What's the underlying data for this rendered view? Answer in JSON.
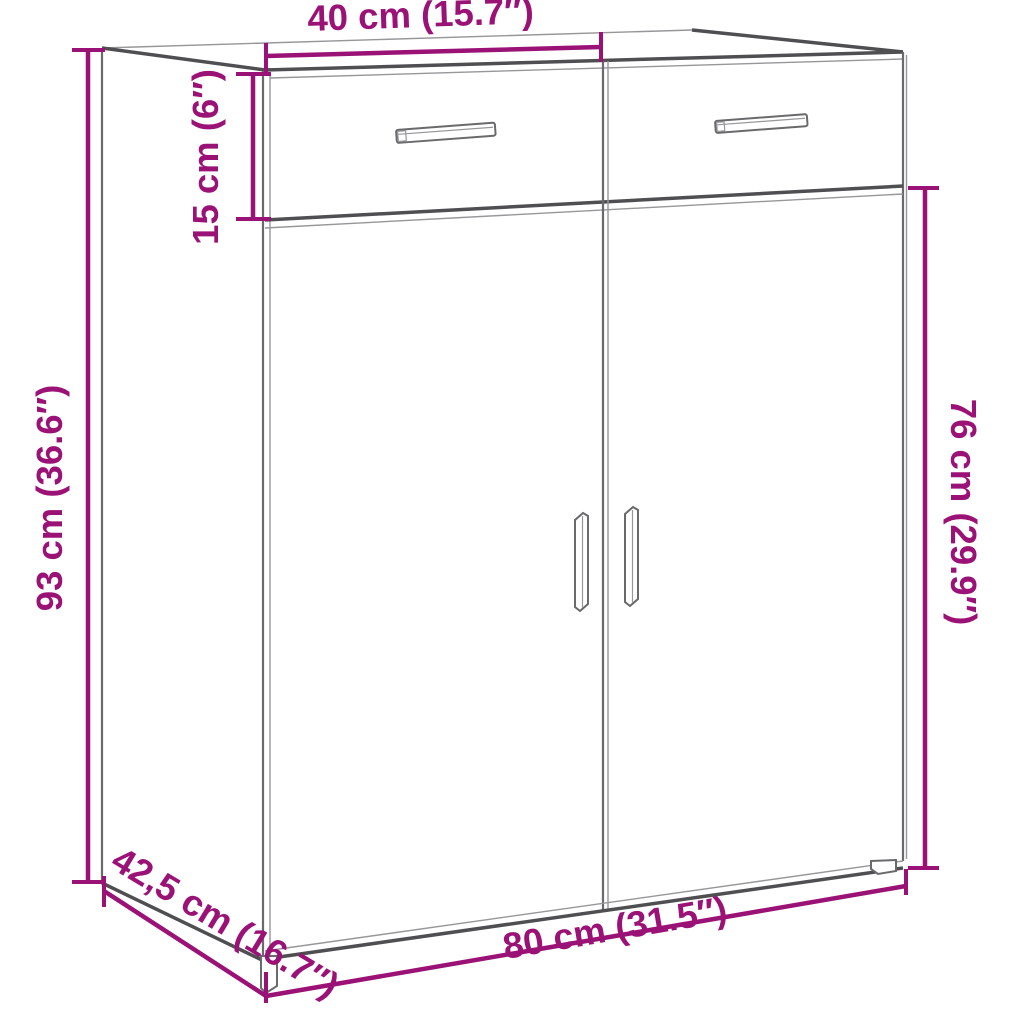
{
  "image": {
    "kind": "furniture dimension diagram",
    "subject": "sideboard cabinet with two drawers and two doors",
    "background": "#ffffff"
  },
  "colors": {
    "accent": "#9B1277",
    "line": "#4f4f51",
    "line_med": "#6a6a6c",
    "line_thin": "#97979a"
  },
  "dimensions": {
    "drawer_section_width": {
      "label": "40 cm (15.7″)"
    },
    "drawer_height": {
      "label": "15 cm (6″)"
    },
    "overall_height": {
      "label": "93 cm (36.6″)"
    },
    "door_section_height": {
      "label": "76 cm (29.9″)"
    },
    "depth": {
      "label": "42,5 cm (16.7″)"
    },
    "overall_width": {
      "label": "80 cm (31.5″)"
    }
  }
}
